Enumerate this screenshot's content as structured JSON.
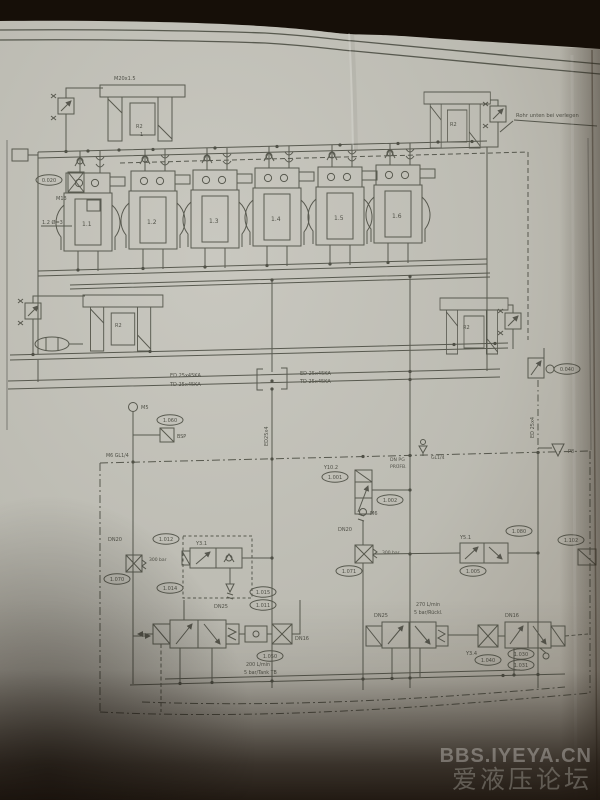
{
  "watermark": {
    "line1": "BBS.IYEYA.CN",
    "line2": "爱液压论坛"
  },
  "annotation": {
    "pipe_note": "Rohr unten bei verlegen"
  },
  "cylinders": {
    "labels": [
      "1.1",
      "1.2",
      "1.3",
      "1.4",
      "1.5",
      "1.6"
    ]
  },
  "accumulator": {
    "label": "R2",
    "sub": "1",
    "fitting": "M20x1.5"
  },
  "pipes": {
    "ed_left": "ED 25x45KA",
    "td_left": "TD 25x45KA",
    "ed_right": "ED 25x45KA",
    "td_right": "TD 25x45KA",
    "drop_center": "ED25x4",
    "drop_right": "ED 25x4",
    "orifice_note": "1.2 Ø=3"
  },
  "ports": {
    "m13": "M13",
    "m5": "M5",
    "m6": "M6",
    "m6_gl": "M6 GL1/4",
    "bsp": "BSP",
    "gl14": "GL1/4",
    "p8": "P8",
    "test_line1": "DN PG",
    "test_line2": "PRÜFB."
  },
  "sizes": {
    "dn20_a": "DN20",
    "dn20_b": "DN20",
    "dn25_a": "DN25",
    "dn25_b": "DN25",
    "dn16_a": "DN16",
    "dn16_b": "DN16",
    "bar_a": "300 bar",
    "bar_b": "300 bar"
  },
  "coils": {
    "y31": "Y3.1",
    "y102": "Y10.2",
    "y51": "Y5.1",
    "y34": "Y3.4"
  },
  "flows": {
    "a1": "200 L/min",
    "a2": "5 bar/Tank TB",
    "b1": "270 L/min",
    "b2": "5 bar/Rückl."
  },
  "tags": {
    "t0020": "0.020",
    "t1060": "1.060",
    "t1012": "1.012",
    "t1070": "1.070",
    "t1014": "1.014",
    "t1015": "1.015",
    "t1011": "1.011",
    "t1001": "1.001",
    "t1002": "1.002",
    "t1080": "1.080",
    "t1005": "1.005",
    "t1071": "1.071",
    "t1050": "1.050",
    "t1040": "1.040",
    "t1030": "1.030",
    "t1031": "1.031",
    "t0040": "0.040",
    "t1102": "1.102"
  }
}
